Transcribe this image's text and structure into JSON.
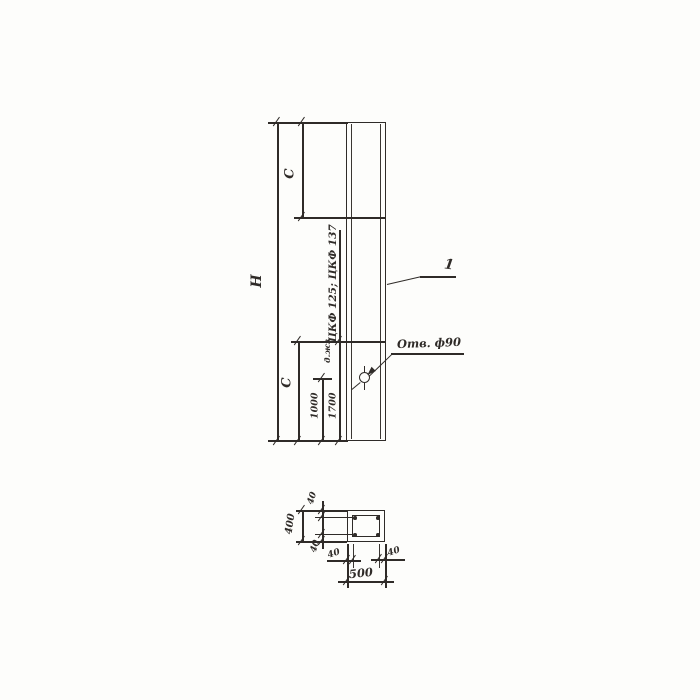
{
  "colors": {
    "ink": "#2f2b28",
    "paper": "#fdfdfb"
  },
  "elevation": {
    "overall_height_label": "H",
    "top_segment_label": "C",
    "bottom_segment_label": "C",
    "column_marks_label": "ЦКФ 125; ЦКФ 137",
    "aux_label": "д.жз",
    "hole_callout": "Отв. ф90",
    "item_number": "1",
    "dim_hole_from_bottom": "1000",
    "dim_joint_from_bottom": "1700"
  },
  "section": {
    "overall_width": "500",
    "overall_height": "400",
    "cover_top": "40",
    "cover_bottom": "40",
    "cover_left": "40",
    "cover_right": "40"
  }
}
